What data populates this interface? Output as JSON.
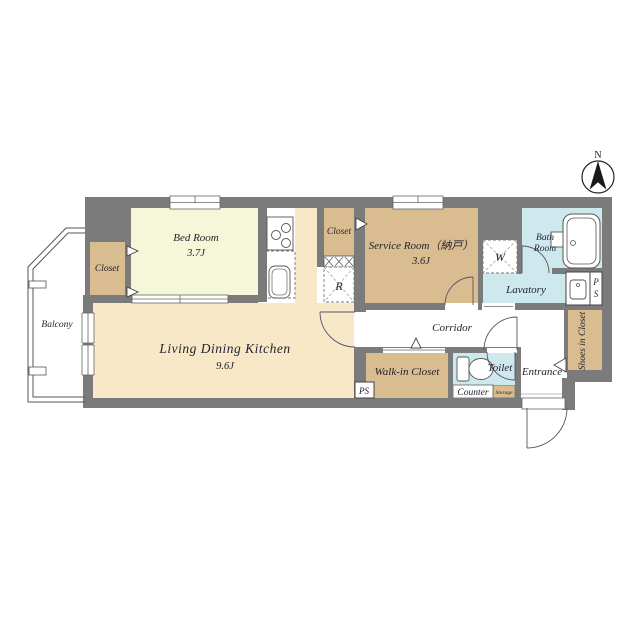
{
  "plan": {
    "compass": {
      "north": "N"
    },
    "rooms": {
      "bedroom": {
        "name": "Bed Room",
        "size": "3.7J"
      },
      "bedroom_closet": {
        "name": "Closet"
      },
      "service_closet": {
        "name": "Closet"
      },
      "service_room": {
        "name": "Service Room（納戸）",
        "size": "3.6J"
      },
      "bath": {
        "line1": "Bath",
        "line2": "Room"
      },
      "lavatory": {
        "name": "Lavatory"
      },
      "ldk": {
        "name": "Living Dining Kitchen",
        "size": "9.6J"
      },
      "balcony": {
        "name": "Balcony"
      },
      "corridor": {
        "name": "Corridor"
      },
      "walk_in_closet": {
        "name": "Walk-in Closet"
      },
      "toilet": {
        "name": "Toilet"
      },
      "counter": {
        "name": "Counter"
      },
      "storage": {
        "name": "Storage"
      },
      "entrance": {
        "name": "Entrance"
      },
      "shoes_closet": {
        "name": "Shoes in Closet"
      }
    },
    "fixtures": {
      "washer": "W",
      "refrigerator": "R",
      "ps_right_line1": "P",
      "ps_right_line2": "S",
      "ps_bottom": "PS"
    },
    "colors": {
      "wall": "#7b7b7b",
      "tan": "#d9bc8f",
      "cream": "#f6f7d9",
      "peach": "#f8e8c8",
      "blue": "#cde9ee",
      "white": "#ffffff"
    }
  }
}
